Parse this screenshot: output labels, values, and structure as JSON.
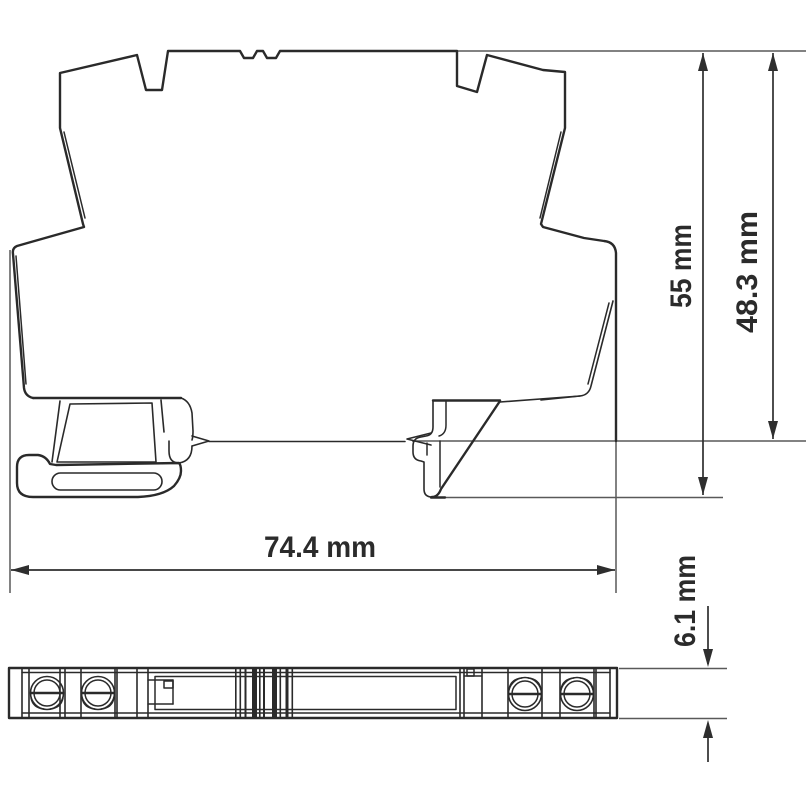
{
  "page": {
    "title": "Terminal block dimensional drawing",
    "background": "#ffffff"
  },
  "colors": {
    "outline": "#2a2a2a",
    "dimension": "#2e2e2e",
    "extension": "#595959",
    "text": "#2b2b2b",
    "background": "#ffffff"
  },
  "views": {
    "side_view": "side-profile-of-din-rail-module",
    "bottom_view": "bottom-view-of-6.1mm-module"
  },
  "dimensions": [
    {
      "id": "overall-width",
      "label": "74.4 mm",
      "orientation": "horizontal"
    },
    {
      "id": "overall-height",
      "label": "55 mm",
      "orientation": "vertical"
    },
    {
      "id": "height-above-rail",
      "label": "48.3 mm",
      "orientation": "vertical"
    },
    {
      "id": "module-thickness",
      "label": "6.1 mm",
      "orientation": "vertical"
    }
  ]
}
